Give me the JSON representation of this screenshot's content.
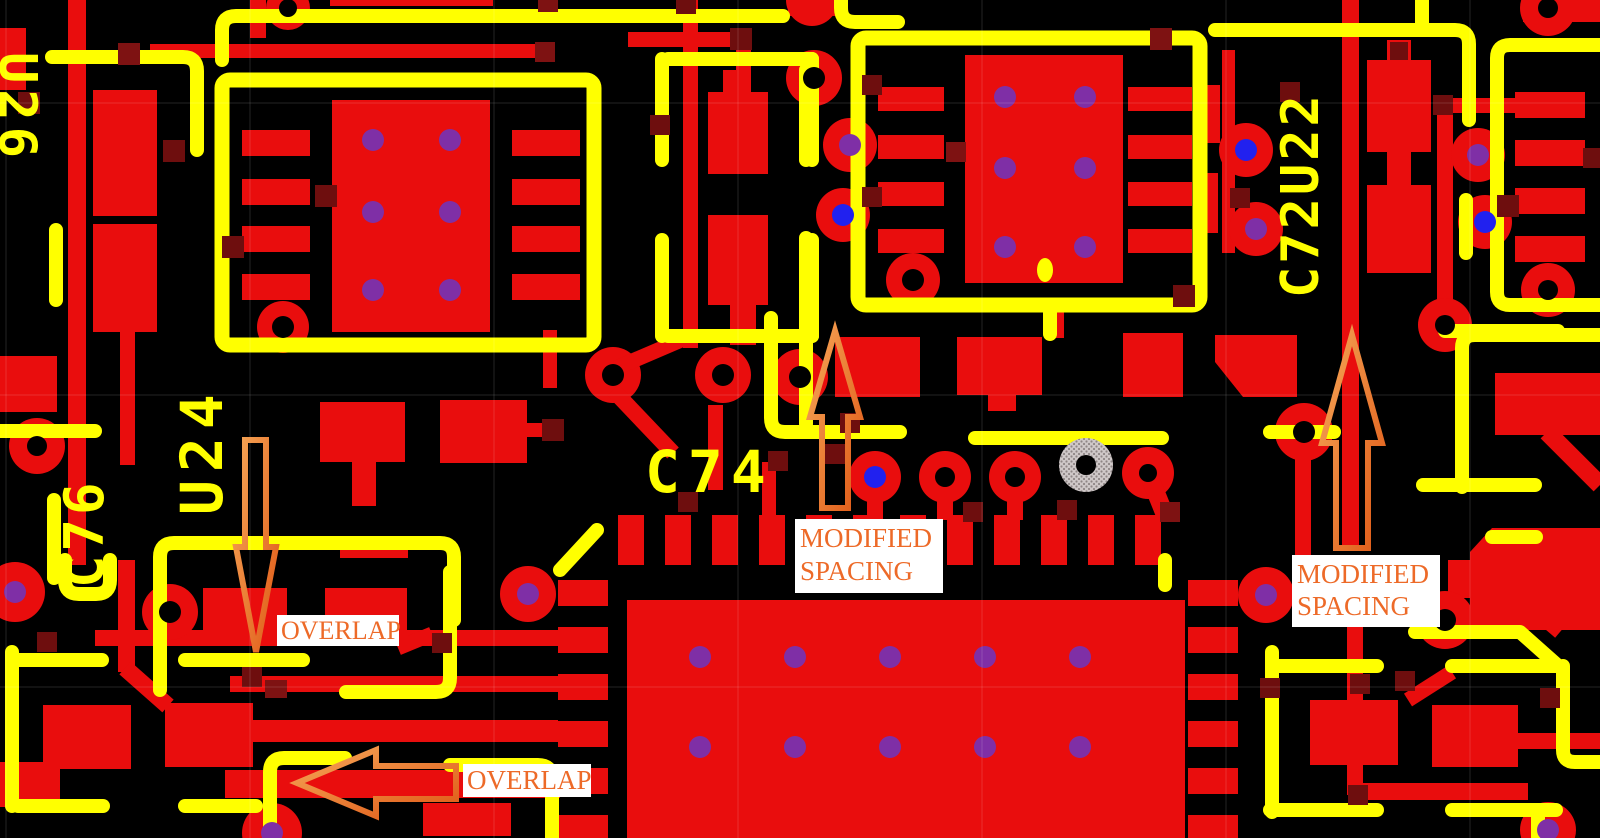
{
  "view": {
    "type": "pcb-layout-canvas",
    "width": 1600,
    "height": 838
  },
  "colors": {
    "background": "#000000",
    "copper": "#E90D0D",
    "silkscreen": "#FFFF00",
    "annotation_orange": "#ED7228",
    "annotation_text": "#ED6A28",
    "label_background": "#FFFFFF",
    "via_purple": "#7F2FA6",
    "via_blue": "#2121EF",
    "pad_hole": "#000000",
    "junction_marker": "#6E0E0E",
    "hatched_pad": "#CFC8C8"
  },
  "silkscreen": {
    "u26": "U26",
    "c76": "C76",
    "u24": "U24",
    "c74": "C74",
    "c72u22": "C72U22"
  },
  "annotations": {
    "modified_spacing_center": {
      "line1": "MODIFIED",
      "line2": "SPACING"
    },
    "modified_spacing_right": {
      "line1": "MODIFIED",
      "line2": "SPACING"
    },
    "overlap_upper": {
      "text": "OVERLAP"
    },
    "overlap_lower": {
      "text": "OVERLAP"
    }
  }
}
